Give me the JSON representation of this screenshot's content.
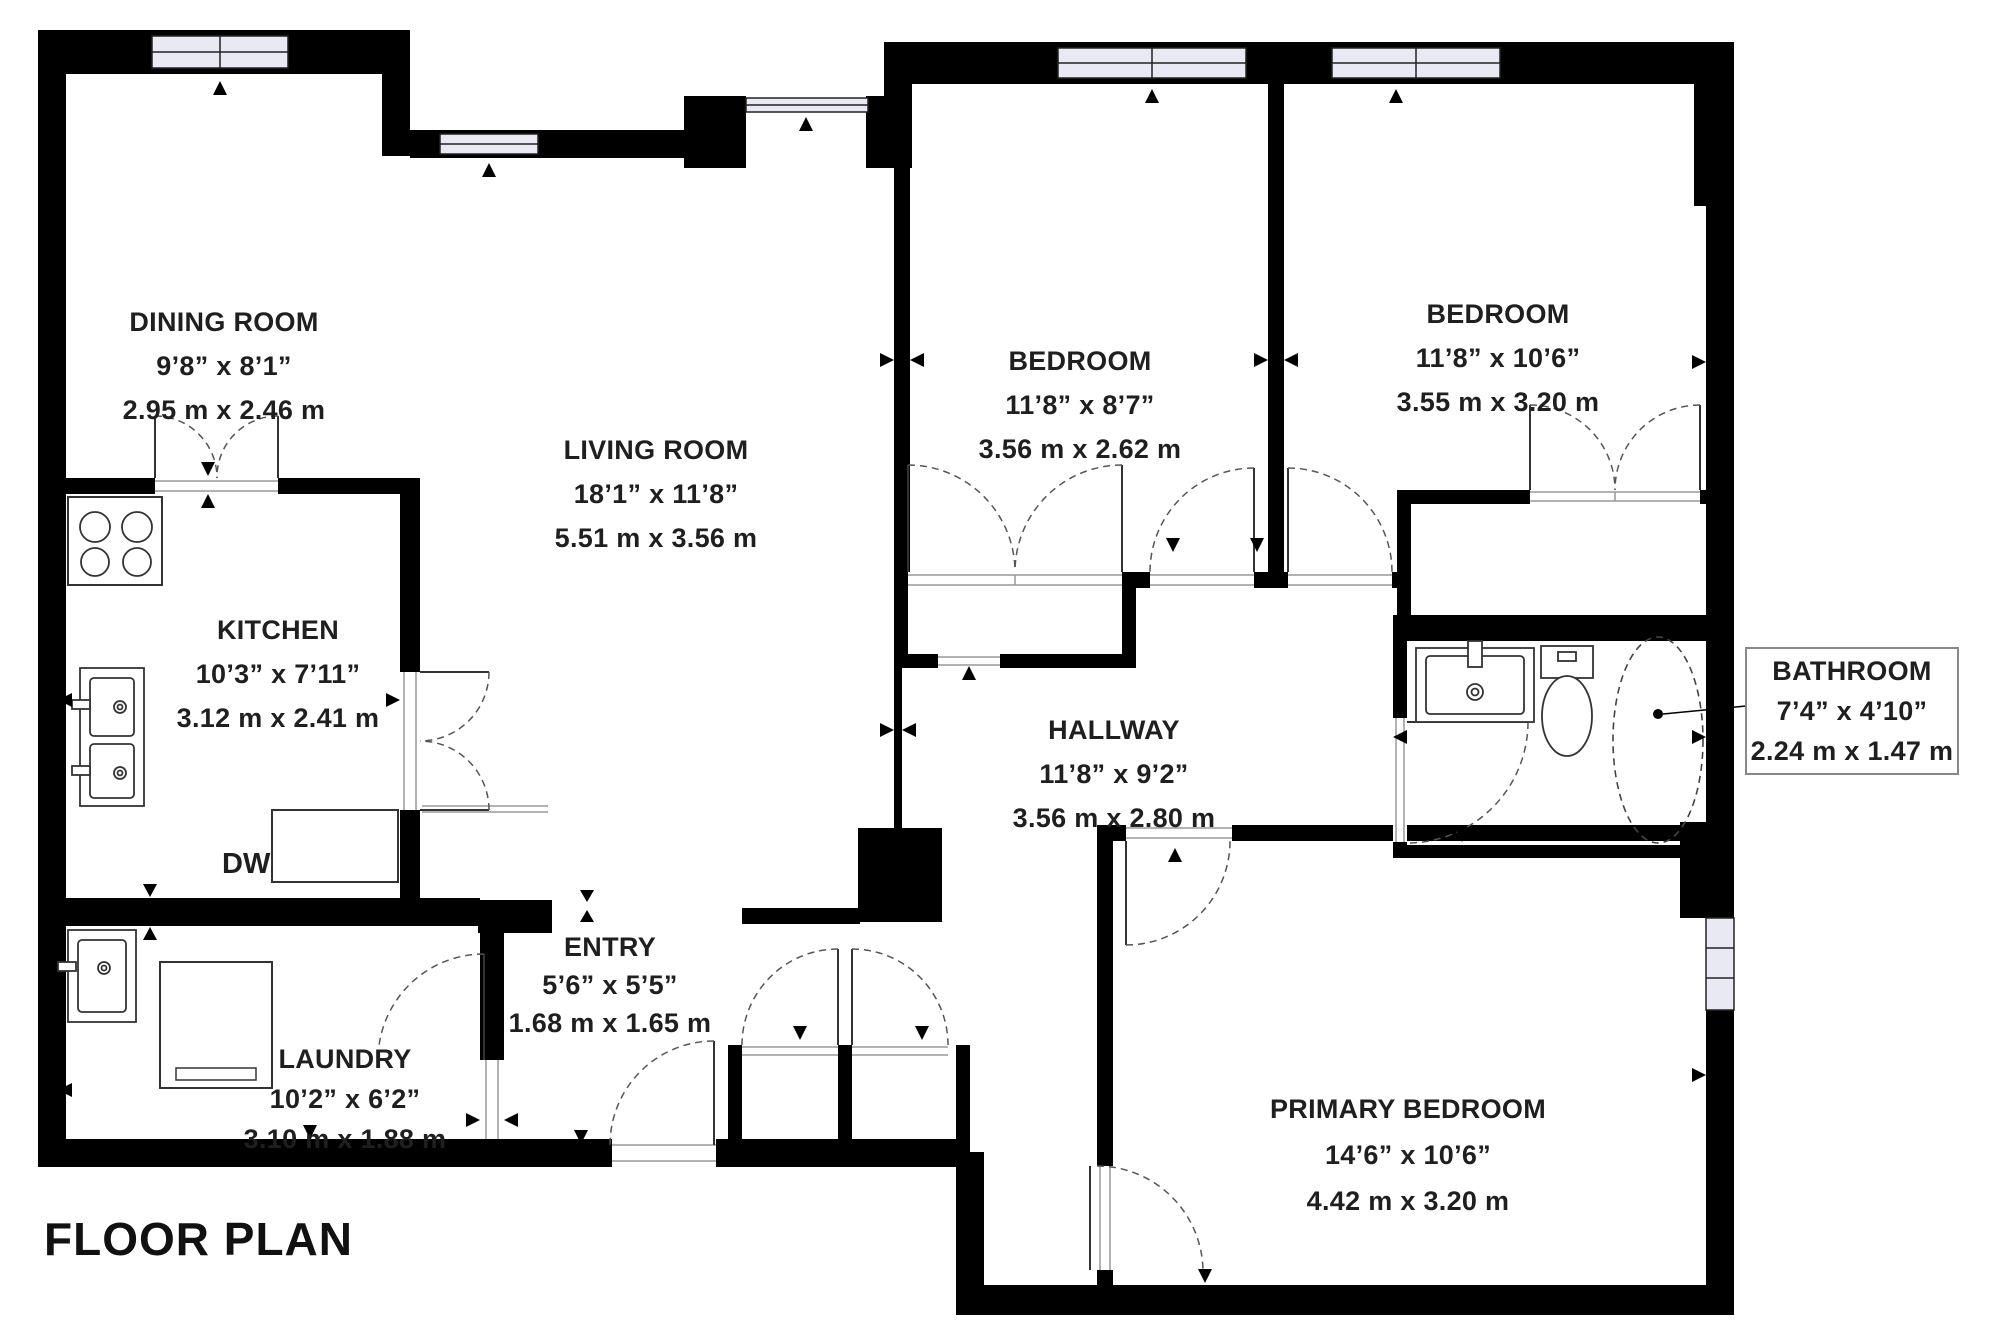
{
  "title": "FLOOR PLAN",
  "rooms": {
    "dining": {
      "name": "DINING ROOM",
      "imperial": "9’8” x 8’1”",
      "metric": "2.95 m x 2.46 m"
    },
    "living": {
      "name": "LIVING ROOM",
      "imperial": "18’1” x 11’8”",
      "metric": "5.51 m x 3.56 m"
    },
    "kitchen": {
      "name": "KITCHEN",
      "imperial": "10’3” x 7’11”",
      "metric": "3.12 m x 2.41 m"
    },
    "bedroom_middle": {
      "name": "BEDROOM",
      "imperial": "11’8” x 8’7”",
      "metric": "3.56 m x 2.62 m"
    },
    "bedroom_right": {
      "name": "BEDROOM",
      "imperial": "11’8” x 10’6”",
      "metric": "3.55 m x 3.20 m"
    },
    "hallway": {
      "name": "HALLWAY",
      "imperial": "11’8” x 9’2”",
      "metric": "3.56 m x 2.80 m"
    },
    "entry": {
      "name": "ENTRY",
      "imperial": "5’6” x 5’5”",
      "metric": "1.68 m x 1.65 m"
    },
    "laundry": {
      "name": "LAUNDRY",
      "imperial": "10’2” x 6’2”",
      "metric": "3.10 m x 1.88 m"
    },
    "primary": {
      "name": "PRIMARY BEDROOM",
      "imperial": "14’6” x 10’6”",
      "metric": "4.42 m x 3.20 m"
    },
    "bathroom": {
      "name": "BATHROOM",
      "imperial": "7’4” x 4’10”",
      "metric": "2.24 m x 1.47 m"
    }
  },
  "appliances": {
    "dishwasher": "DW"
  },
  "colors": {
    "wall": "#000000",
    "text": "#1f1f1f",
    "window_fill": "#e9e9f4",
    "label_box_border": "#888888"
  }
}
